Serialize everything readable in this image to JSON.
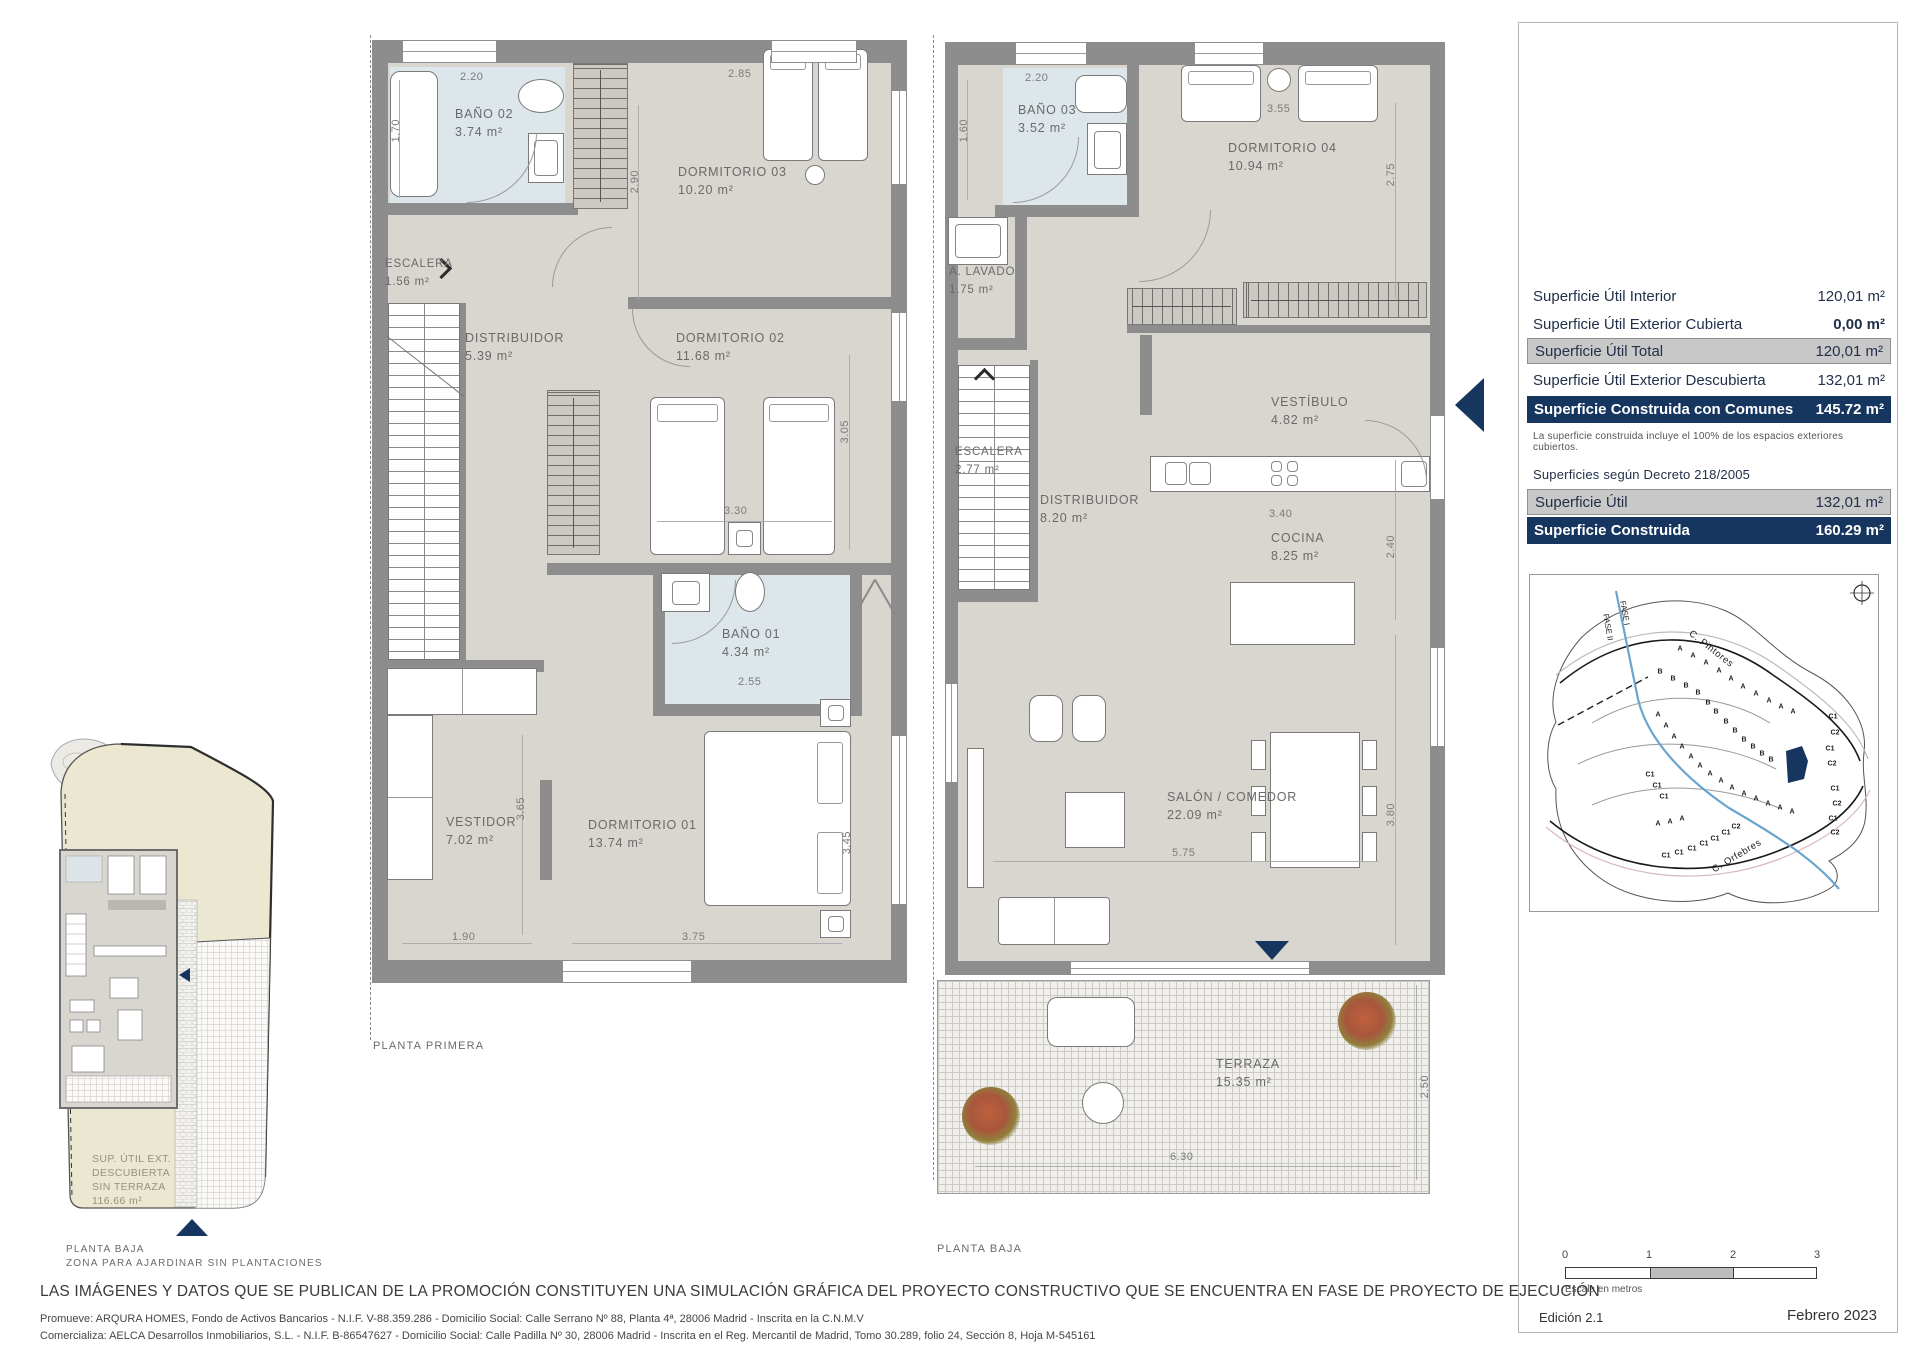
{
  "page": {
    "disclaimer": "LAS IMÁGENES Y DATOS QUE SE PUBLICAN DE LA PROMOCIÓN CONSTITUYEN UNA SIMULACIÓN GRÁFICA DEL PROYECTO CONSTRUCTIVO QUE SE ENCUENTRA EN FASE DE PROYECTO DE EJECUCIÓN",
    "promoter": "Promueve: ARQURA HOMES, Fondo de Activos Bancarios - N.I.F. V-88.359.286 - Domicilio Social: Calle Serrano Nº 88, Planta 4ª, 28006 Madrid - Inscrita en la C.N.M.V",
    "marketer": "Comercializa: AELCA Desarrollos Inmobiliarios, S.L. - N.I.F. B-86547627 - Domicilio Social: Calle Padilla Nº 30, 28006 Madrid - Inscrita en el Reg. Mercantil de Madrid, Tomo 30.289, folio 24, Sección 8, Hoja M-545161"
  },
  "plan_primera": {
    "caption": "PLANTA PRIMERA",
    "rooms": {
      "bano02": {
        "name": "BAÑO 02",
        "area": "3.74 m²"
      },
      "dorm03": {
        "name": "DORMITORIO 03",
        "area": "10.20 m²"
      },
      "escalera": {
        "name": "ESCALERA",
        "area": "1.56 m²"
      },
      "distribuidor": {
        "name": "DISTRIBUIDOR",
        "area": "5.39 m²"
      },
      "dorm02": {
        "name": "DORMITORIO 02",
        "area": "11.68 m²"
      },
      "bano01": {
        "name": "BAÑO 01",
        "area": "4.34 m²"
      },
      "vestidor": {
        "name": "VESTIDOR",
        "area": "7.02 m²"
      },
      "dorm01": {
        "name": "DORMITORIO 01",
        "area": "13.74 m²"
      }
    },
    "dims": {
      "b2w": "2.20",
      "b2h": "1.70",
      "d3w": "2.85",
      "d3h": "2.90",
      "d2w": "3.30",
      "d2h": "3.05",
      "b1w": "2.55",
      "vh": "3.65",
      "vw": "1.90",
      "d1w": "3.75",
      "d1h": "3.45"
    }
  },
  "plan_baja": {
    "caption": "PLANTA BAJA",
    "rooms": {
      "bano03": {
        "name": "BAÑO 03",
        "area": "3.52 m²"
      },
      "dorm04": {
        "name": "DORMITORIO 04",
        "area": "10.94 m²"
      },
      "lavado": {
        "name": "A. LAVADO",
        "area": "1.75 m²"
      },
      "vestibulo": {
        "name": "VESTÍBULO",
        "area": "4.82 m²"
      },
      "escalera": {
        "name": "ESCALERA",
        "area": "2.77 m²"
      },
      "distribuidor": {
        "name": "DISTRIBUIDOR",
        "area": "8.20 m²"
      },
      "cocina": {
        "name": "COCINA",
        "area": "8.25 m²"
      },
      "salon": {
        "name": "SALÓN / COMEDOR",
        "area": "22.09 m²"
      },
      "terraza": {
        "name": "TERRAZA",
        "area": "15.35 m²"
      }
    },
    "dims": {
      "b3w": "2.20",
      "b3h": "1.60",
      "d4w": "3.55",
      "d4h": "2.75",
      "cw": "3.40",
      "ch": "2.40",
      "sw": "5.75",
      "sh": "3.80",
      "tw": "6.30",
      "th": "2.50"
    }
  },
  "site_plan": {
    "label": [
      "SUP. ÚTIL EXT.",
      "DESCUBIERTA",
      "SIN TERRAZA",
      "116.66 m²"
    ],
    "caption1": "PLANTA BAJA",
    "caption2": "ZONA PARA AJARDINAR SIN PLANTACIONES"
  },
  "panel": {
    "surface_table": {
      "rows": [
        {
          "label": "Superficie Útil Interior",
          "value": "120,01 m²"
        },
        {
          "label": "Superficie Útil Exterior Cubierta",
          "value": "0,00 m²"
        },
        {
          "label": "Superficie Útil Total",
          "value": "120,01 m²"
        },
        {
          "label": "Superficie Útil Exterior Descubierta",
          "value": "132,01 m²"
        },
        {
          "label": "Superficie Construida con Comunes",
          "value": "145.72 m²"
        }
      ],
      "note": "La superficie construida incluye el 100% de los espacios exteriores cubiertos.",
      "decree_heading": "Superficies según Decreto 218/2005",
      "decree_rows": [
        {
          "label": "Superficie Útil",
          "value": "132,01 m²"
        },
        {
          "label": "Superficie Construida",
          "value": "160.29 m²"
        }
      ]
    },
    "map": {
      "street_top": "C. Pintores",
      "street_bottom": "C. Orfebres",
      "fase_a": "FASE I",
      "fase_b": "FASE II",
      "lots": [
        {
          "t": "A",
          "x": 150,
          "y": 74
        },
        {
          "t": "A",
          "x": 163,
          "y": 81
        },
        {
          "t": "A",
          "x": 176,
          "y": 88
        },
        {
          "t": "A",
          "x": 189,
          "y": 96
        },
        {
          "t": "A",
          "x": 201,
          "y": 104
        },
        {
          "t": "A",
          "x": 213,
          "y": 112
        },
        {
          "t": "A",
          "x": 226,
          "y": 119
        },
        {
          "t": "A",
          "x": 239,
          "y": 126
        },
        {
          "t": "A",
          "x": 251,
          "y": 132
        },
        {
          "t": "A",
          "x": 263,
          "y": 137
        },
        {
          "t": "B",
          "x": 130,
          "y": 97
        },
        {
          "t": "B",
          "x": 143,
          "y": 104
        },
        {
          "t": "B",
          "x": 156,
          "y": 111
        },
        {
          "t": "B",
          "x": 168,
          "y": 118
        },
        {
          "t": "B",
          "x": 178,
          "y": 128
        },
        {
          "t": "B",
          "x": 186,
          "y": 137
        },
        {
          "t": "B",
          "x": 196,
          "y": 147
        },
        {
          "t": "B",
          "x": 205,
          "y": 156
        },
        {
          "t": "B",
          "x": 214,
          "y": 165
        },
        {
          "t": "B",
          "x": 223,
          "y": 172
        },
        {
          "t": "B",
          "x": 232,
          "y": 179
        },
        {
          "t": "B",
          "x": 241,
          "y": 185
        },
        {
          "t": "A",
          "x": 128,
          "y": 140
        },
        {
          "t": "A",
          "x": 136,
          "y": 151
        },
        {
          "t": "A",
          "x": 144,
          "y": 162
        },
        {
          "t": "A",
          "x": 152,
          "y": 172
        },
        {
          "t": "A",
          "x": 161,
          "y": 182
        },
        {
          "t": "A",
          "x": 170,
          "y": 191
        },
        {
          "t": "A",
          "x": 180,
          "y": 199
        },
        {
          "t": "A",
          "x": 191,
          "y": 206
        },
        {
          "t": "A",
          "x": 202,
          "y": 213
        },
        {
          "t": "A",
          "x": 214,
          "y": 219
        },
        {
          "t": "A",
          "x": 226,
          "y": 224
        },
        {
          "t": "A",
          "x": 238,
          "y": 229
        },
        {
          "t": "A",
          "x": 250,
          "y": 233
        },
        {
          "t": "A",
          "x": 262,
          "y": 237
        },
        {
          "t": "C1",
          "x": 303,
          "y": 142
        },
        {
          "t": "C2",
          "x": 305,
          "y": 158
        },
        {
          "t": "C1",
          "x": 300,
          "y": 174
        },
        {
          "t": "C2",
          "x": 302,
          "y": 189
        },
        {
          "t": "C1",
          "x": 305,
          "y": 214
        },
        {
          "t": "C2",
          "x": 307,
          "y": 229
        },
        {
          "t": "C1",
          "x": 303,
          "y": 244
        },
        {
          "t": "C2",
          "x": 305,
          "y": 258
        },
        {
          "t": "C1",
          "x": 120,
          "y": 200
        },
        {
          "t": "C1",
          "x": 127,
          "y": 211
        },
        {
          "t": "C1",
          "x": 134,
          "y": 222
        },
        {
          "t": "A",
          "x": 128,
          "y": 249
        },
        {
          "t": "A",
          "x": 140,
          "y": 247
        },
        {
          "t": "A",
          "x": 152,
          "y": 244
        },
        {
          "t": "C2",
          "x": 206,
          "y": 252
        },
        {
          "t": "C1",
          "x": 196,
          "y": 258
        },
        {
          "t": "C1",
          "x": 185,
          "y": 264
        },
        {
          "t": "C1",
          "x": 174,
          "y": 269
        },
        {
          "t": "C1",
          "x": 162,
          "y": 274
        },
        {
          "t": "C1",
          "x": 149,
          "y": 278
        },
        {
          "t": "C1",
          "x": 136,
          "y": 281
        }
      ]
    },
    "scale_bar": {
      "ticks": [
        "0",
        "1",
        "2",
        "3"
      ],
      "caption": "Escala en metros"
    },
    "edition": "Edición 2.1",
    "date": "Febrero 2023"
  },
  "colors": {
    "navy": "#16365f",
    "wall": "#8d8d8d",
    "floor": "#d9d6d0",
    "bath": "#dde6ea",
    "row_gray": "#c9c8c8"
  }
}
